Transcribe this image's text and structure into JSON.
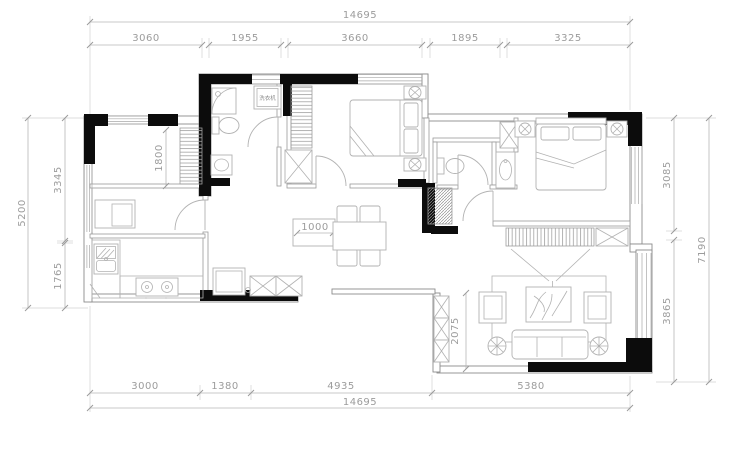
{
  "plan": {
    "type": "residential-floor-plan",
    "washer_label": "洗衣机"
  },
  "dims": {
    "top_overall": "14695",
    "top_segs": [
      "3060",
      "1955",
      "3660",
      "1895",
      "3325"
    ],
    "bottom_segs": [
      "3000",
      "1380",
      "4935",
      "5380"
    ],
    "bottom_overall": "14695",
    "left_segs": [
      "3345",
      "1765"
    ],
    "left_overall": "5200",
    "right_segs": [
      "3085",
      "3865"
    ],
    "right_overall": "7190",
    "interior_closet": "1800",
    "interior_sideboard": "1000",
    "interior_balcony": "2075"
  },
  "colors": {
    "structural_wall": "#0c0c0c",
    "thin_wall": "#8c8c8c",
    "dimension_text": "#9c9c9c",
    "background": "#ffffff"
  }
}
